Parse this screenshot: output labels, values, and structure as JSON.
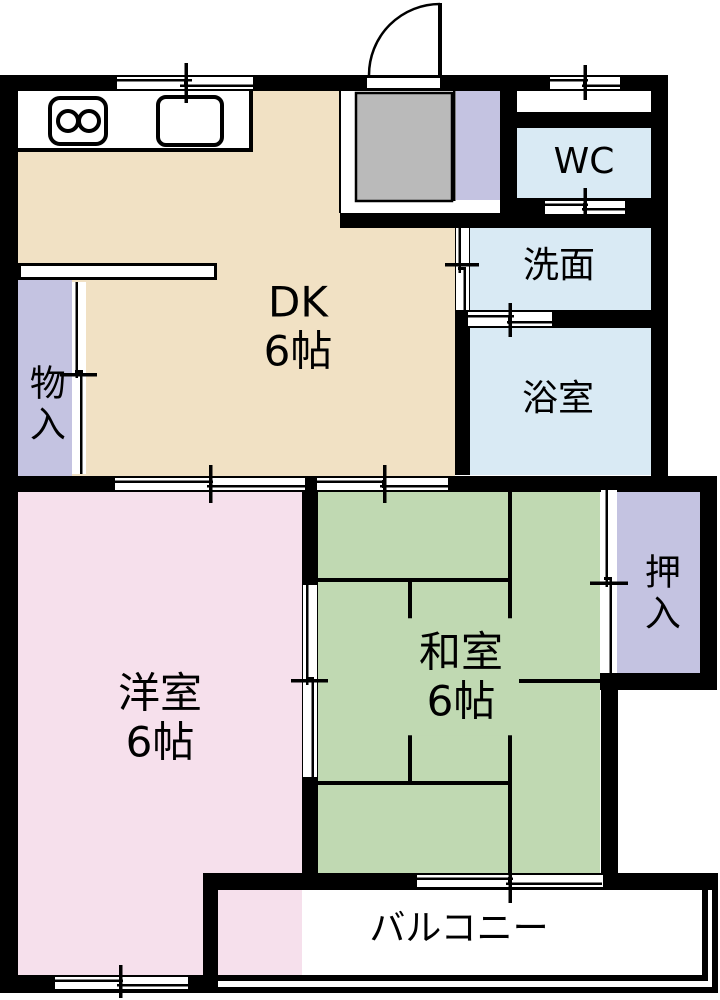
{
  "palette": {
    "wall": "#000000",
    "dk_beige": "#f1e1c4",
    "western_pink": "#f6e0ec",
    "tatami_green": "#c0d9b2",
    "water_blue": "#d9eaf4",
    "closet_purple": "#c4c3e1",
    "genkan_gray": "#bababa",
    "white": "#ffffff"
  },
  "rooms": {
    "dk": {
      "label": "DK",
      "size": "6帖"
    },
    "washitsu": {
      "label": "和室",
      "size": "6帖"
    },
    "youshitsu": {
      "label": "洋室",
      "size": "6帖"
    },
    "wc": {
      "label": "WC"
    },
    "senmen": {
      "label": "洗面"
    },
    "yokushitsu": {
      "label": "浴室"
    },
    "monoire": {
      "label": "物入"
    },
    "oshiire": {
      "label": "押入"
    },
    "balcony": {
      "label": "バルコニー"
    }
  },
  "icons": {
    "stove": "two-burner-stove",
    "sink": "kitchen-sink",
    "entry_door": "entry-door-swing",
    "sliding_window": "sliding-window",
    "sliding_door": "sliding-door"
  }
}
